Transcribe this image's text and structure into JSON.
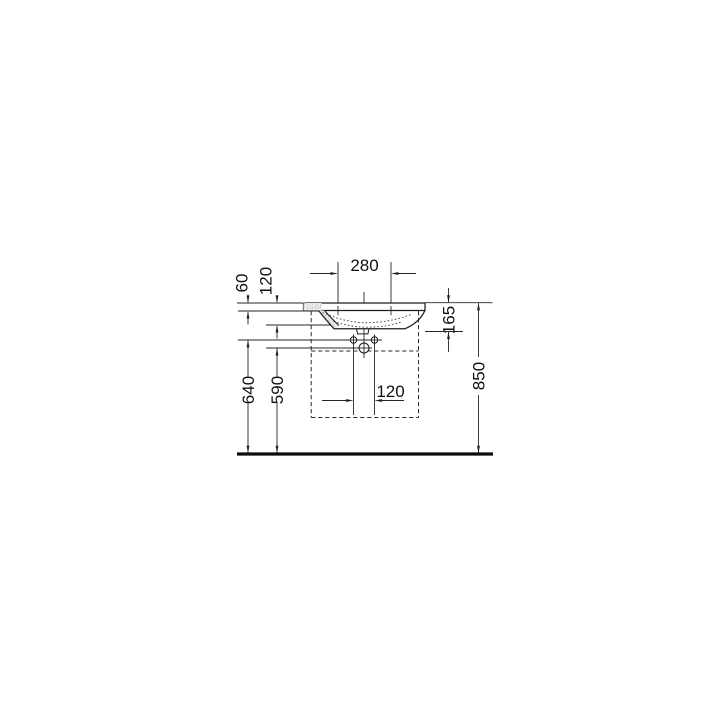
{
  "page": {
    "background": "#ffffff"
  },
  "drawing": {
    "kind": "wall-mounted washbasin technical installation drawing, front elevation with half section",
    "line_color": "#262626",
    "units": "mm",
    "dims": {
      "tap_hole_spacing": "280",
      "rim_to_tap_centerline": "60",
      "inner_basin_depth": "120",
      "ceramic_edge_height": "165",
      "fixing_holes_floor_height": "640",
      "drain_floor_height": "590",
      "fixing_hole_spacing": "120",
      "rim_floor_height": "850"
    }
  }
}
